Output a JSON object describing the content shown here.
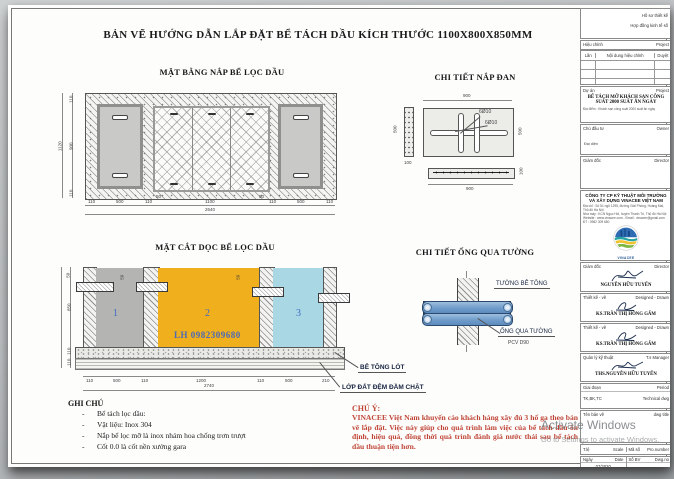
{
  "sheet": {
    "title": "BẢN VẼ HƯỚNG DẪN LẮP ĐẶT BỂ TÁCH DẦU KÍCH THƯỚC 1100X800X850MM"
  },
  "plan": {
    "title": "MẶT BẰNG NẮP BỂ LỌC DẦU",
    "dims_bottom": [
      "110",
      "500",
      "110",
      "50",
      "1100",
      "50",
      "110",
      "500",
      "110"
    ],
    "dim_total_bottom": "2640",
    "dims_left": [
      "110",
      "900",
      "110"
    ],
    "dim_total_left": "1120"
  },
  "lid_detail": {
    "title": "CHI TIẾT NẮP ĐAN",
    "dim_top": "900",
    "dim_right": "500",
    "dim_left_side": "500",
    "dim_side_width": "100",
    "dim_bar_length": "900",
    "dim_bar_height": "100",
    "rebar_label_a": "6Ø10",
    "rebar_label_b": "6Ø10"
  },
  "section": {
    "title": "MẶT CẮT DỌC BỂ LỌC DẦU",
    "chamber_1": "1",
    "chamber_2": "2",
    "chamber_3": "3",
    "watermark_phone": "LH 0982309680",
    "dims_bottom": [
      "110",
      "500",
      "110",
      "1200",
      "110",
      "500",
      "210"
    ],
    "dim_total_bottom": "2740",
    "dims_left": [
      "50",
      "850",
      "110",
      "110"
    ],
    "callout_concrete": "BÊ TÔNG LÓT",
    "callout_soil": "LỚP ĐẤT ĐỆM ĐẦM CHẶT"
  },
  "pipe_detail": {
    "title": "CHI TIẾT ỐNG QUA TƯỜNG",
    "label_wall": "TƯỜNG BÊ TÔNG",
    "label_pipe": "ỐNG QUA TƯỜNG",
    "label_pipe_size": "PCV D90"
  },
  "notes": {
    "title": "GHI CHÚ",
    "items": [
      "Bể tách lọc dầu:",
      "Vật liệu: Inox 304",
      "Nắp bể lọc mỡ là inox nhám hoa chống trơn trượt",
      "Cốt 0.0 là cốt nền xưởng gara"
    ]
  },
  "warning": {
    "title": "CHÚ Ý:",
    "body": "VINACEE Việt Nam khuyến cáo khách hàng xây đủ 3 hố ga theo bản vẽ lắp đặt. Việc này giúp cho quá trình làm việc của bể tách dầu ổn định, hiệu quả, đồng thời quá trình đánh giá nước thải sau bể tách dầu thuận tiện hơn."
  },
  "titleblock": {
    "doc_line1": "Hồ sơ thiết kế",
    "doc_line2": "Hợp đồng kinh tế số",
    "rev_title": "Hiệu chỉnh",
    "rev_title_en": "Project",
    "rev_col_no": "Lần",
    "rev_col_content": "Nội dung hiệu chỉnh",
    "rev_col_approve": "Duyệt",
    "project_label": "Dự án",
    "project_label_en": "Project",
    "project_name": "BỂ TÁCH MỠ KHÁCH SẠN CÔNG SUẤT 2000 SUẤT ĂN NGÀY",
    "project_sub": "Địa điểm : Khách sạn công suất 2000 suất ăn ngày",
    "owner_label": "Chủ đầu tư",
    "owner_label_en": "Owner",
    "owner_rep": "Đại diện",
    "director_label": "Giám đốc",
    "director_label_en": "Director",
    "company_name": "CÔNG TY  CP KỸ THUẬT MÔI TRƯỜNG VÀ XÂY DỰNG VINACEE VIỆT NAM",
    "company_addr1": "Địa chỉ : Số 51 ngõ 1295, đường Giải Phóng, Hoàng Mai, Thủ đô Hà Nội",
    "company_addr2": "Nhà máy : KCN Ngọc Hồi, huyện Thanh Trì, Thủ đô Hà Nội",
    "company_addr3": "Website : www.vinacee.com - Email : vinacee@gmail.com",
    "company_addr4": "ĐT : 0982 309 680",
    "logo_caption": "VINACEE",
    "sig1_label": "Giám đốc",
    "sig1_label_en": "Director",
    "sig1_name": "NGUYỄN HỮU TUYẾN",
    "sig2_label": "Thiết kế - vẽ",
    "sig2_label_en": "Designed - Drawn",
    "sig2_name": "KS.TRẦN THỊ HỒNG GẤM",
    "sig3_label": "Thiết kế - vẽ",
    "sig3_label_en": "Designed - Drawn",
    "sig3_name": "KS.TRẦN THỊ HỒNG GẤM",
    "sig4_label": "Quản lý kỹ thuật",
    "sig4_label_en": "T.s Manager",
    "sig4_name": "THS.NGUYỄN HỮU TUYẾN",
    "stage_label": "Giai đoạn",
    "stage_label_en": "Period",
    "stage_value": "TK,BK,TC",
    "stage_value_en": "Technical dwg",
    "dwg_title_label": "Tên bản vẽ",
    "dwg_title_label_en": "dwg title",
    "scale_label": "T.lệ",
    "scale_label_en": "Scale",
    "code_label": "Mã số",
    "code_label_en": "Pro.number",
    "date_label": "Ngày",
    "date_label_en": "Date",
    "date_value": "07/2020",
    "no_label": "Số BV",
    "no_label_en": "Dwg.no"
  },
  "os_watermark": {
    "line1": "Activate Windows",
    "line2": "Go to Settings to activate Windows."
  }
}
